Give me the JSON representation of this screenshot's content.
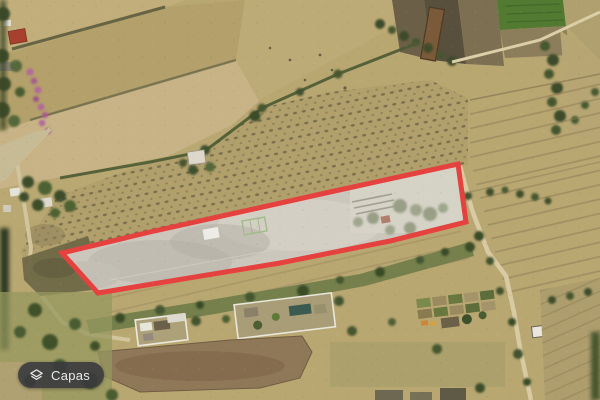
{
  "map": {
    "kind": "satellite",
    "parcel": {
      "points": "62,253 150,232 330,192 458,164 466,222 390,241 280,263 98,293",
      "stroke_color": "#e5413e",
      "fill_color": "rgba(255,255,255,0.22)",
      "stroke_width": "5"
    }
  },
  "controls": {
    "layers_button": {
      "label": "Capas",
      "icon": "layers-icon"
    }
  }
}
